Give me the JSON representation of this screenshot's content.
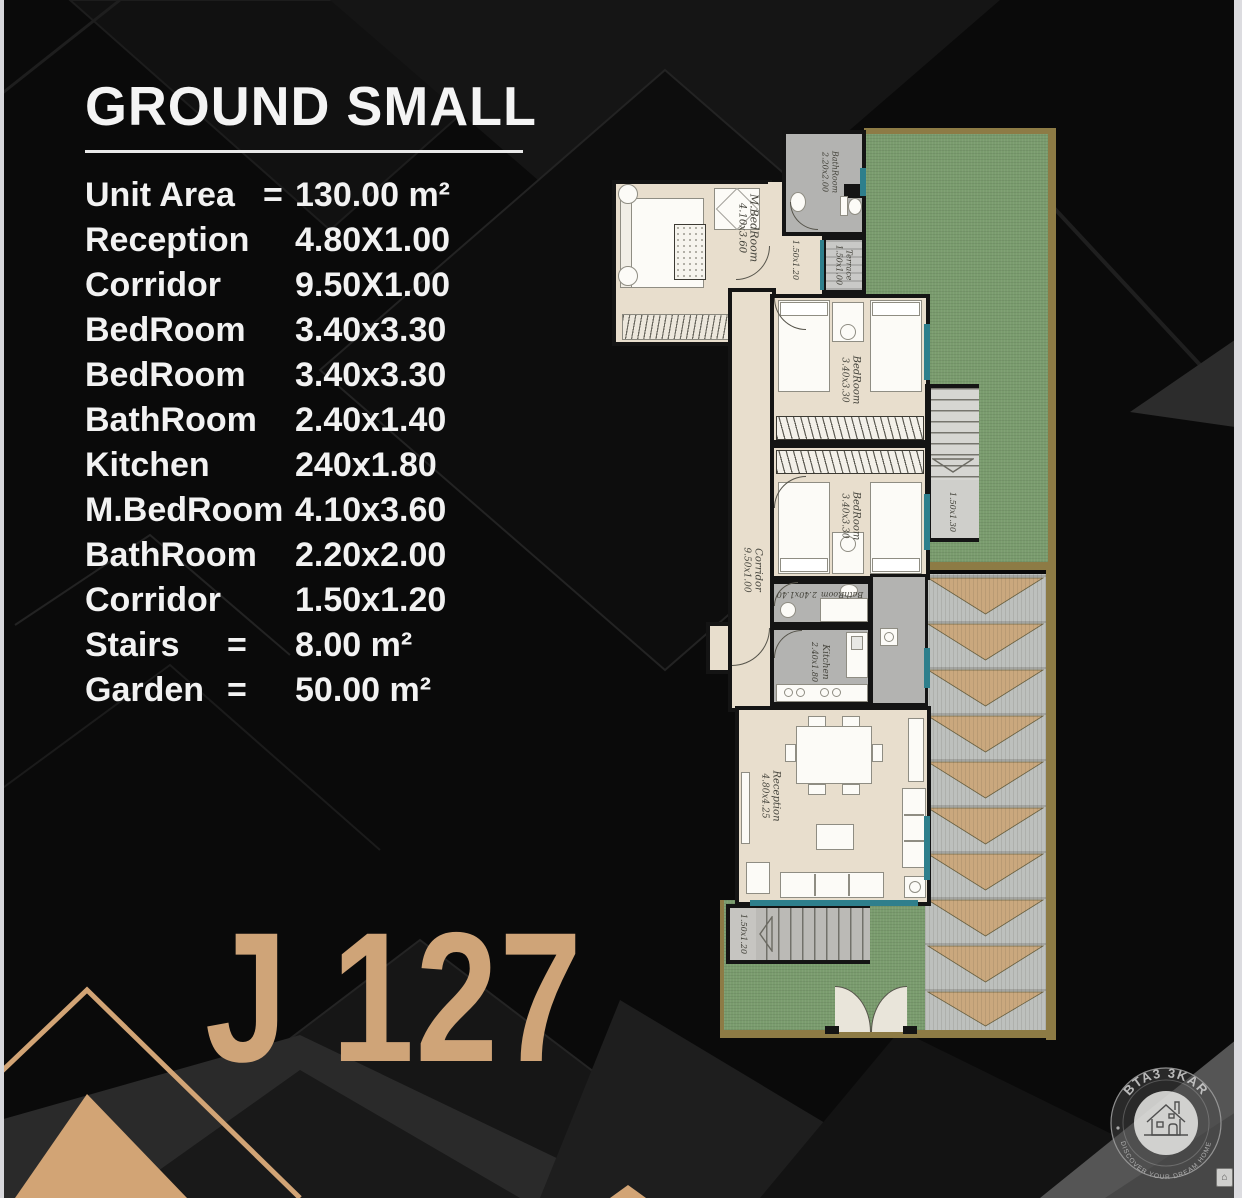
{
  "page": {
    "title": "GROUND SMALL",
    "unit_code": "J 127"
  },
  "specs": [
    {
      "label": "Unit Area",
      "eq": "=",
      "value": "130.00 m²"
    },
    {
      "label": "Reception",
      "eq": "",
      "value": "4.80X1.00"
    },
    {
      "label": "Corridor",
      "eq": "",
      "value": "9.50X1.00"
    },
    {
      "label": "BedRoom",
      "eq": "",
      "value": "3.40x3.30"
    },
    {
      "label": "BedRoom",
      "eq": "",
      "value": "3.40x3.30"
    },
    {
      "label": "BathRoom",
      "eq": "",
      "value": "2.40x1.40"
    },
    {
      "label": "Kitchen",
      "eq": "",
      "value": "240x1.80"
    },
    {
      "label": "M.BedRoom",
      "eq": "",
      "value": "4.10x3.60"
    },
    {
      "label": "BathRoom",
      "eq": "",
      "value": "2.20x2.00"
    },
    {
      "label": "Corridor",
      "eq": "",
      "value": "1.50x1.20"
    },
    {
      "label": "Stairs",
      "eq": "=",
      "value": "8.00 m²"
    },
    {
      "label": "Garden",
      "eq": "=",
      "value": "50.00 m²"
    }
  ],
  "plan": {
    "rooms": [
      {
        "name": "M.BedRoom",
        "dims": "4.10x3.60"
      },
      {
        "name": "BathRoom",
        "dims": "2.20x2.00"
      },
      {
        "name": "Terrace",
        "dims": "1.50x1.00"
      },
      {
        "name": "",
        "dims": "1.50x1.20"
      },
      {
        "name": "BedRoom",
        "dims": "3.40x3.30"
      },
      {
        "name": "BedRoom",
        "dims": "3.40x3.30"
      },
      {
        "name": "BathRoom",
        "dims": "2.40x1.40"
      },
      {
        "name": "Kitchen",
        "dims": "2.40x1.80"
      },
      {
        "name": "Corridor",
        "dims": "9.50x1.00"
      },
      {
        "name": "",
        "dims": "1.50x1.30"
      },
      {
        "name": "Reception",
        "dims": "4.80x4.25"
      },
      {
        "name": "",
        "dims": "1.50x1.20"
      }
    ]
  },
  "logo": {
    "brand": "BTA3 3KAR",
    "tagline": "DISCOVER YOUR DREAM HOME"
  },
  "colors": {
    "accent_tan": "#cfa478",
    "floor_beige": "#e8decd",
    "wet_gray": "#b3b3b1",
    "garden_green": "#7a9c6e",
    "garden_border_olive": "#8d7b45",
    "deck_wood": "#caa87e",
    "window_teal": "#2e7f8c",
    "text_white": "#f2f2f2",
    "background_black": "#080808"
  }
}
